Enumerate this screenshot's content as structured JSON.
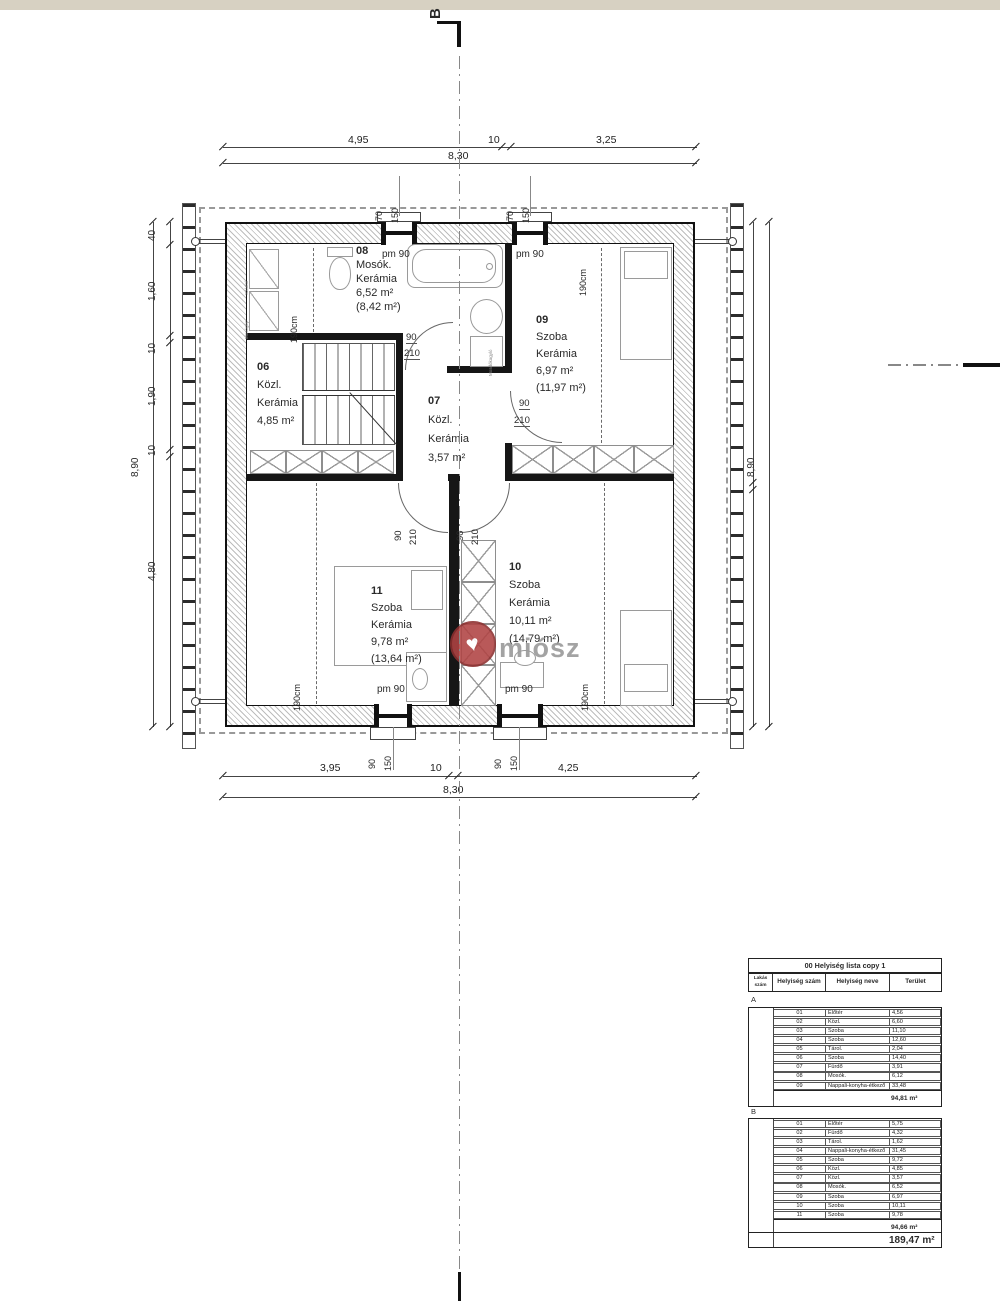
{
  "marker": {
    "top": "B"
  },
  "logo": {
    "text": "miósz"
  },
  "dims": {
    "top": {
      "seg1": "4,95",
      "seg2": "10",
      "seg3": "3,25",
      "total": "8,30"
    },
    "bottom": {
      "seg1": "3,95",
      "seg2": "10",
      "seg3": "4,25",
      "total": "8,30"
    },
    "left": {
      "seg1": "40",
      "seg2": "1,60",
      "seg3": "10",
      "seg4": "1,90",
      "seg5": "10",
      "seg6": "4,80",
      "total": "8,90"
    },
    "right": {
      "seg1": "4,60",
      "seg2": "10",
      "seg3": "4,20",
      "total": "8,90"
    },
    "window_top": {
      "w": "70",
      "h": "150"
    },
    "window_bottom": {
      "w": "90",
      "h": "150"
    }
  },
  "labels": {
    "pm90": "pm 90",
    "headroom": "190cm",
    "door_w": "90",
    "door_h": "210"
  },
  "fixtures": {
    "dryer": "Szárító",
    "washer": "Mosógép",
    "basin": "Mosdókagyló"
  },
  "rooms": {
    "r06": {
      "number": "06",
      "name": "Közl.",
      "material": "Kerámia",
      "area": "4,85 m²"
    },
    "r07": {
      "number": "07",
      "name": "Közl.",
      "material": "Kerámia",
      "area": "3,57 m²"
    },
    "r08": {
      "number": "08",
      "name": "Mosók.",
      "material": "Kerámia",
      "area": "6,52 m²",
      "area_gross": "(8,42 m²)"
    },
    "r09": {
      "number": "09",
      "name": "Szoba",
      "material": "Kerámia",
      "area": "6,97 m²",
      "area_gross": "(11,97 m²)"
    },
    "r10": {
      "number": "10",
      "name": "Szoba",
      "material": "Kerámia",
      "area": "10,11 m²",
      "area_gross": "(14,79 m²)"
    },
    "r11": {
      "number": "11",
      "name": "Szoba",
      "material": "Kerámia",
      "area": "9,78 m²",
      "area_gross": "(13,64 m²)"
    }
  },
  "table": {
    "title": "00 Helyiség lista copy 1",
    "headers": {
      "col1": "Lakás szám",
      "col2": "Helyiség szám",
      "col3": "Helyiség neve",
      "col4": "Terület"
    },
    "sectionA": {
      "label": "A",
      "rows": [
        {
          "num": "01",
          "name": "Előtér",
          "area": "4,56"
        },
        {
          "num": "02",
          "name": "Közl.",
          "area": "6,60"
        },
        {
          "num": "03",
          "name": "Szoba",
          "area": "11,10"
        },
        {
          "num": "04",
          "name": "Szoba",
          "area": "12,60"
        },
        {
          "num": "05",
          "name": "Tárol.",
          "area": "2,04"
        },
        {
          "num": "06",
          "name": "Szoba",
          "area": "14,40"
        },
        {
          "num": "07",
          "name": "Fürdő",
          "area": "3,91"
        },
        {
          "num": "08",
          "name": "Mosók.",
          "area": "6,12"
        },
        {
          "num": "09",
          "name": "Nappali-konyha-étkező",
          "area": "33,48"
        }
      ],
      "total": "94,81 m²"
    },
    "sectionB": {
      "label": "B",
      "rows": [
        {
          "num": "01",
          "name": "Előtér",
          "area": "5,75"
        },
        {
          "num": "02",
          "name": "Fürdő",
          "area": "4,32"
        },
        {
          "num": "03",
          "name": "Tárol.",
          "area": "1,62"
        },
        {
          "num": "04",
          "name": "Nappali-konyha-étkező",
          "area": "31,45"
        },
        {
          "num": "05",
          "name": "Szoba",
          "area": "9,72"
        },
        {
          "num": "06",
          "name": "Közl.",
          "area": "4,85"
        },
        {
          "num": "07",
          "name": "Közl.",
          "area": "3,57"
        },
        {
          "num": "08",
          "name": "Mosók.",
          "area": "6,52"
        },
        {
          "num": "09",
          "name": "Szoba",
          "area": "6,97"
        },
        {
          "num": "10",
          "name": "Szoba",
          "area": "10,11"
        },
        {
          "num": "11",
          "name": "Szoba",
          "area": "9,78"
        }
      ],
      "total": "94,66 m²"
    },
    "grand_total": "189,47 m²"
  }
}
